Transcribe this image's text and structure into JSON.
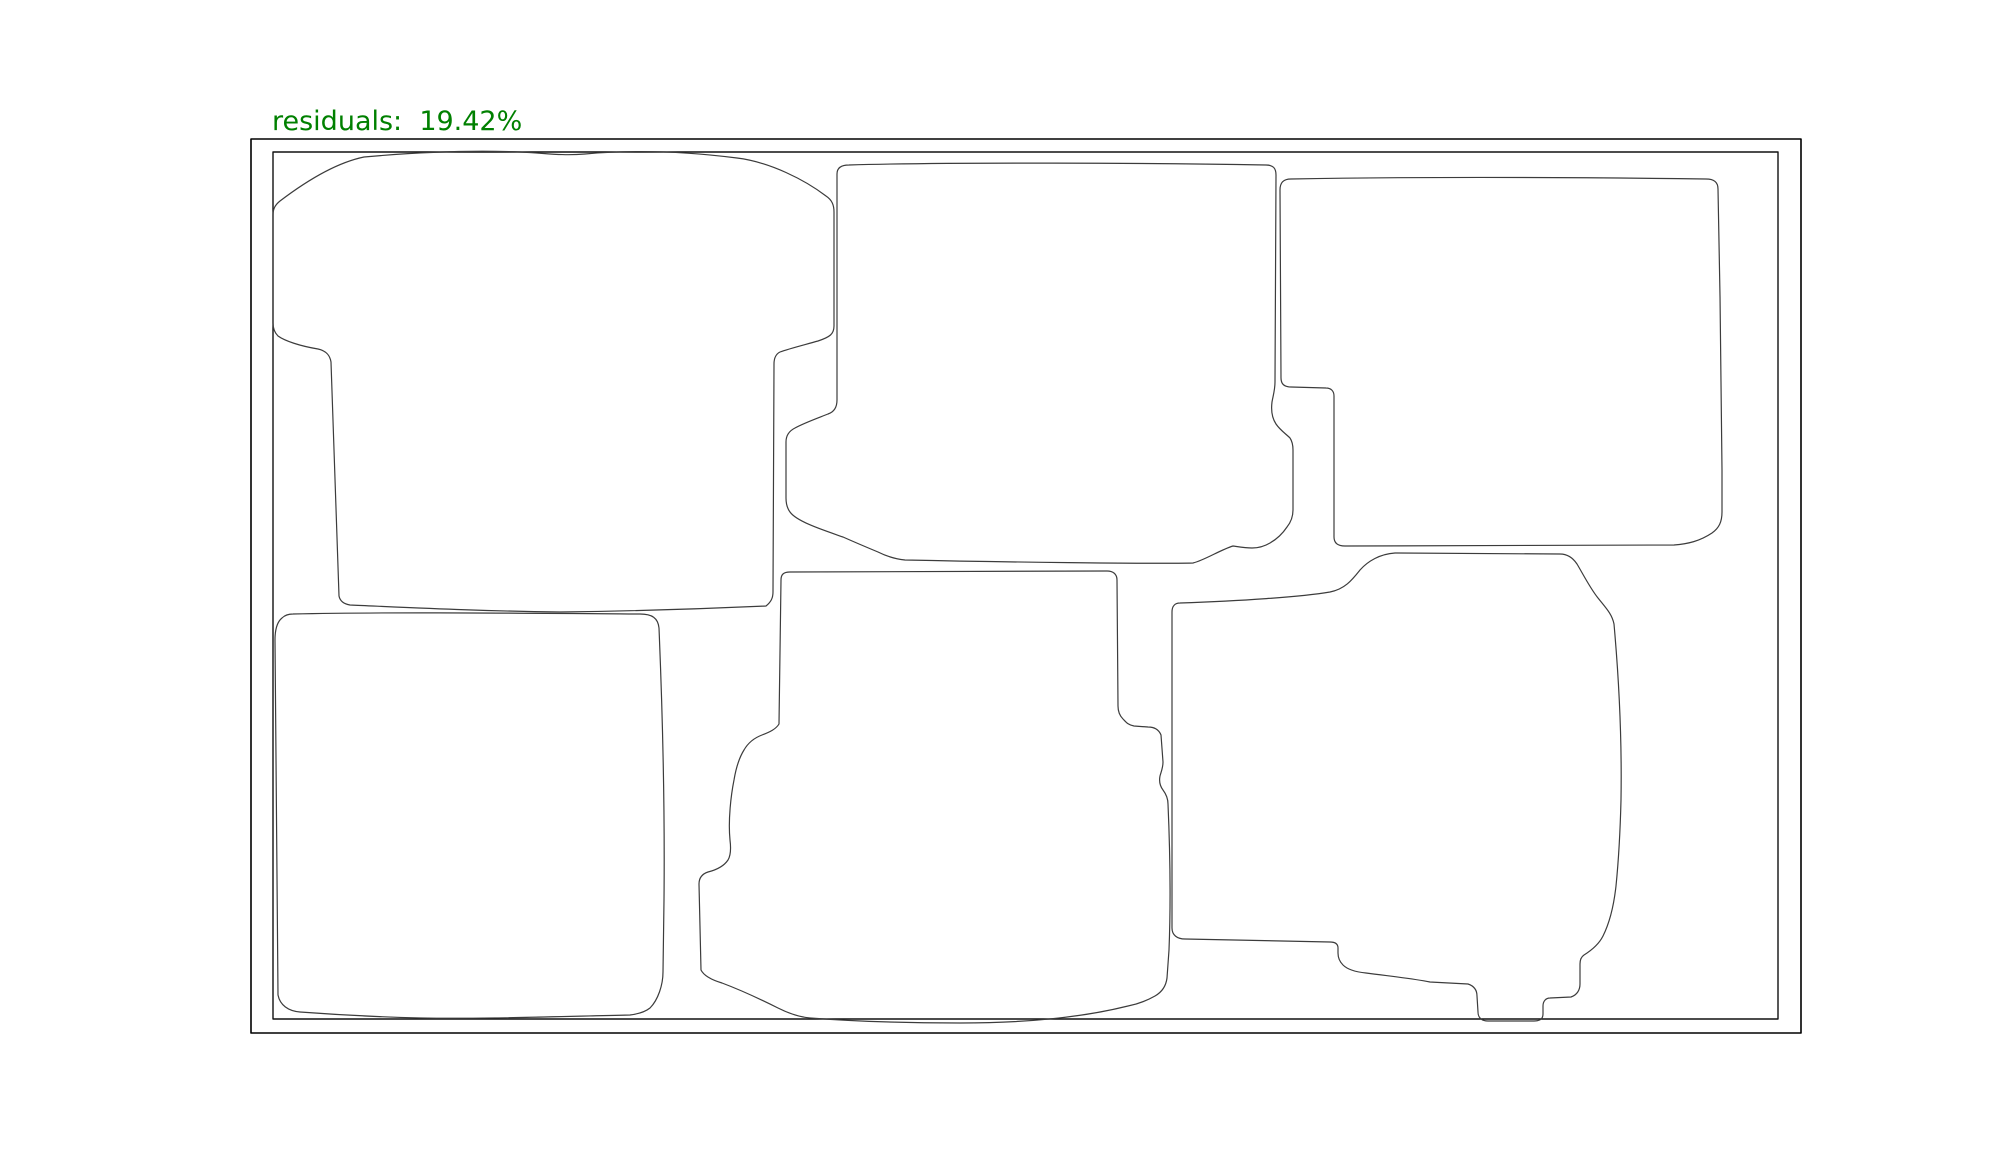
{
  "figure": {
    "width": 2000,
    "height": 1161,
    "background": "#ffffff",
    "label": {
      "text": "residuals:  19.42%",
      "color": "#008000",
      "x": 272,
      "y": 106,
      "font_size": 27
    },
    "boundary": {
      "outer": {
        "x": 251,
        "y": 139,
        "width": 1550,
        "height": 894,
        "stroke": "#000000",
        "stroke_width": 1.6
      },
      "sheet": {
        "x": 273,
        "y": 152,
        "width": 1505,
        "height": 867,
        "stroke": "#111111",
        "stroke_width": 1.4
      }
    },
    "parts_style": {
      "stroke": "#3c3c3c",
      "stroke_width": 1.2,
      "fill": "none"
    },
    "parts": [
      {
        "name": "part-1-front-mat-top-left",
        "path": "M 364,157 C 420,152 470,150 520,152 C 545,153 560,156 585,154 C 640,149 690,152 737,158 C 770,162 805,180 826,196 C 832,200 834,205 834,212 L 834,326 C 834,334 830,337 818,341 C 800,346 788,349 780,352 C 776,354 774,358 774,364 L 773,592 C 773,598 771,602 766,606 C 700,609 640,611 560,612 C 480,611 420,608 350,605 C 344,604 340,601 339,596 L 331,362 C 330,356 327,351 318,349 C 300,346 285,341 278,336 C 275,333 273,329 273,323 L 273,215 C 273,209 275,205 280,201 C 305,182 335,163 364,157 Z"
      },
      {
        "name": "part-2-trunk-mat-top-middle",
        "path": "M 849,165 C 950,162 1150,163 1266,165 C 1273,165 1276,168 1276,175 L 1275,382 C 1275,390 1273,396 1272,402 C 1271,410 1272,418 1276,424 C 1280,430 1286,434 1290,438 C 1292,441 1293,445 1293,450 L 1293,510 C 1293,517 1291,522 1287,527 C 1283,533 1277,539 1270,543 C 1265,546 1259,548 1252,548 C 1246,548 1240,547 1233,546 C 1220,550 1205,560 1193,563 C 1150,564 1000,562 905,560 C 895,559 886,556 878,552 C 866,547 852,541 843,537 C 826,531 797,522 790,512 C 787,508 786,504 786,498 L 786,442 C 786,436 789,431 795,428 C 804,423 818,418 828,414 C 834,412 837,407 837,400 L 837,174 C 837,168 841,165 849,165 Z"
      },
      {
        "name": "part-3-boot-liner-top-right",
        "path": "M 1291,179 C 1400,177 1550,177 1706,179 C 1714,179 1718,182 1718,189 C 1720,280 1722,420 1722,470 L 1722,512 C 1722,522 1719,528 1712,533 C 1700,541 1688,544 1674,545 C 1560,546 1450,546 1345,546 C 1338,546 1334,543 1334,537 L 1334,396 C 1334,391 1331,388 1326,388 L 1291,387 C 1284,387 1281,384 1281,378 L 1280,190 C 1280,183 1283,179 1291,179 Z"
      },
      {
        "name": "part-4-rear-mat-bottom-left",
        "path": "M 293,614 C 380,612 500,613 640,614 C 652,614 658,618 659,628 C 662,700 665,800 664,900 L 663,972 C 663,985 658,1000 650,1008 C 645,1012 638,1014 630,1015 C 540,1017 480,1019 420,1018 C 380,1017 340,1015 300,1012 C 288,1011 280,1005 278,995 L 275,640 C 275,630 277,622 282,618 C 285,615 288,614 293,614 Z"
      },
      {
        "name": "part-5-trunk-mat-bottom-middle",
        "path": "M 790,572 L 1107,571 C 1113,571 1117,574 1117,580 L 1118,706 C 1118,712 1120,716 1123,719 C 1126,722 1128,725 1134,726 L 1148,727 C 1155,727 1159,730 1161,735 L 1163,762 C 1163,768 1161,772 1160,776 C 1159,781 1160,786 1163,790 C 1166,794 1168,798 1168,804 C 1170,850 1171,900 1169,950 L 1167,978 C 1166,986 1162,992 1155,996 C 1148,1000 1138,1004 1128,1006 C 1080,1018 1020,1023 960,1023 C 900,1023 850,1021 810,1018 C 798,1017 786,1012 778,1008 C 760,999 738,989 722,983 C 712,980 704,976 701,970 L 699,884 C 699,878 702,874 708,872 C 716,870 724,866 728,860 C 731,855 731,848 730,840 C 728,820 731,795 734,780 C 736,768 739,758 744,750 C 748,743 754,738 762,735 C 770,732 776,729 779,724 L 781,580 C 781,574 784,572 790,572 Z"
      },
      {
        "name": "part-6-cargo-mat-bottom-right",
        "path": "M 1180,603 C 1240,601 1300,597 1330,592 C 1345,589 1352,580 1360,570 C 1368,561 1380,554 1395,553 L 1560,554 C 1568,554 1573,558 1577,564 C 1583,574 1590,588 1598,598 C 1606,608 1612,614 1614,624 C 1619,680 1622,740 1621,800 C 1620,840 1618,866 1616,886 C 1614,904 1610,922 1603,936 C 1599,944 1592,950 1584,955 C 1581,957 1580,960 1580,964 L 1580,984 C 1580,990 1577,995 1571,997 L 1550,998 C 1546,998 1543,1001 1543,1006 L 1543,1014 C 1543,1019 1540,1021 1534,1021 L 1488,1021 C 1482,1021 1478,1018 1478,1012 L 1477,996 C 1477,990 1474,986 1468,984 L 1430,982 C 1410,978 1388,976 1366,973 C 1356,972 1348,970 1343,965 C 1340,962 1338,958 1338,953 L 1338,948 C 1338,944 1335,942 1330,942 L 1185,939 C 1177,939 1172,935 1172,928 L 1172,612 C 1172,606 1175,603 1180,603 Z"
      }
    ]
  }
}
